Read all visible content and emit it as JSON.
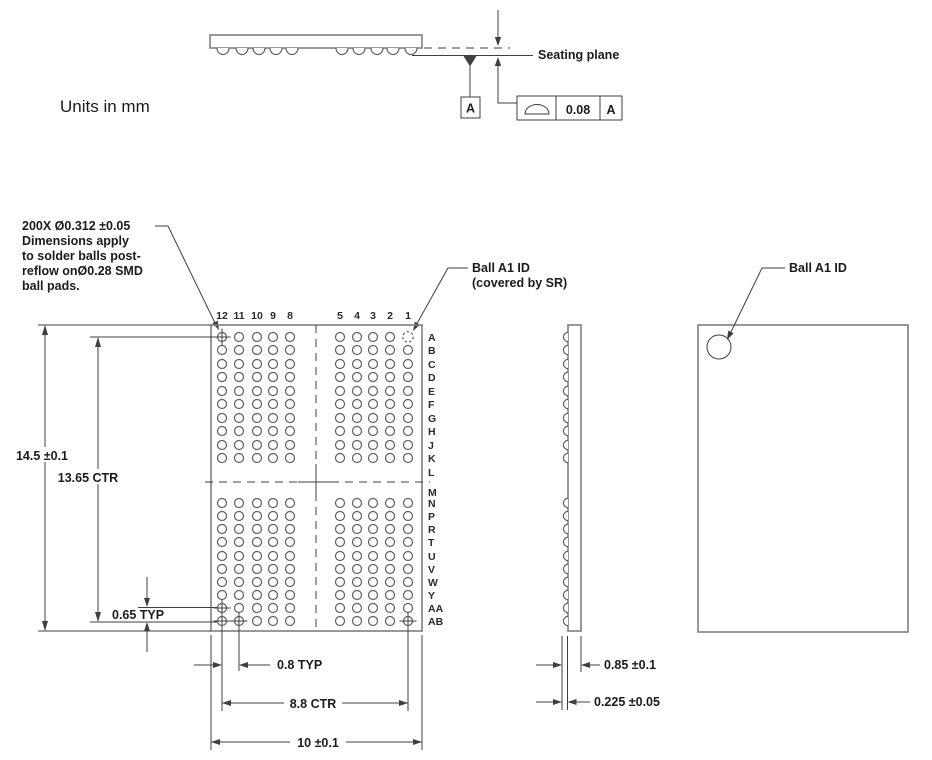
{
  "drawing": {
    "units_note": "Units in mm",
    "elevation": {
      "seating_plane_label": "Seating plane",
      "datum_label": "A",
      "fcf_tolerance": "0.08",
      "fcf_datum": "A"
    },
    "ball_note_lines": [
      "200X Ø0.312 ±0.05",
      "Dimensions apply",
      "to solder balls post-",
      "reflow onØ0.28 SMD",
      "ball pads."
    ],
    "ball_a1_covered_line1": "Ball A1 ID",
    "ball_a1_covered_line2": "(covered by SR)",
    "ball_a1_top_label": "Ball A1 ID",
    "dimensions": {
      "body_height": "14.5 ±0.1",
      "row_span": "13.65 CTR",
      "row_pitch": "0.65 TYP",
      "col_pitch": "0.8 TYP",
      "col_span": "8.8 CTR",
      "body_width": "10 ±0.1",
      "thickness": "0.85 ±0.1",
      "standoff": "0.225 ±0.05"
    },
    "grid": {
      "col_labels_left": [
        "12",
        "11",
        "10",
        "9",
        "8"
      ],
      "col_labels_right": [
        "5",
        "4",
        "3",
        "2",
        "1"
      ],
      "row_labels_top": [
        "A",
        "B",
        "C",
        "D",
        "E",
        "F",
        "G",
        "H",
        "J",
        "K"
      ],
      "row_break_labels": [
        "L",
        "M"
      ],
      "row_labels_bottom": [
        "N",
        "P",
        "R",
        "T",
        "U",
        "V",
        "W",
        "Y",
        "AA",
        "AB"
      ],
      "cross_fiducials": [
        [
          "12",
          "A"
        ],
        [
          "12",
          "AA"
        ],
        [
          "12",
          "AB"
        ],
        [
          "11",
          "AB"
        ],
        [
          "1",
          "AB"
        ]
      ],
      "covered_ball": [
        "1",
        "A"
      ]
    }
  }
}
